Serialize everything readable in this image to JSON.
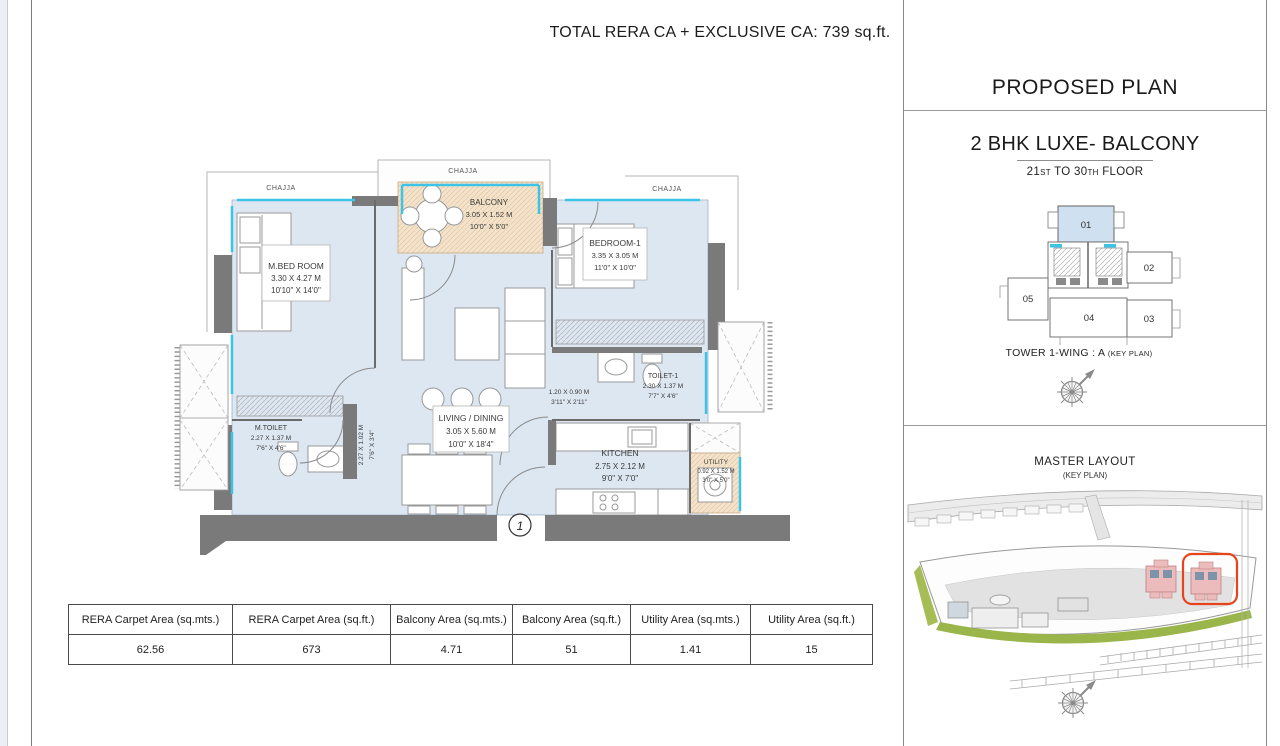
{
  "header": {
    "title": "TOTAL RERA CA + EXCLUSIVE CA: 739 sq.ft."
  },
  "right_panel": {
    "heading": "PROPOSED PLAN",
    "plan_title": "2 BHK LUXE- BALCONY",
    "floor_range": {
      "n1": "21",
      "s1": "ST",
      "mid": " TO 30",
      "s2": "TH",
      "tail": " FLOOR"
    },
    "key_plan": {
      "units": [
        "01",
        "02",
        "03",
        "04",
        "05"
      ],
      "caption": "TOWER 1-WING : A",
      "caption_suffix": "(KEY PLAN)",
      "highlight_color": "#cfe0f0"
    },
    "master_layout": {
      "title": "MASTER LAYOUT",
      "subtitle": "(KEY PLAN)",
      "highlight_color": "#e8441c"
    }
  },
  "floor_plan": {
    "chajja_label": "CHAJJA",
    "entry_marker": "1",
    "rooms": {
      "master_bedroom": {
        "name": "M.BED ROOM",
        "dim_m": "3.30 X 4.27 M",
        "dim_ft": "10'10\" X 14'0\""
      },
      "balcony": {
        "name": "BALCONY",
        "dim_m": "3.05 X 1.52 M",
        "dim_ft": "10'0\" X 5'0\""
      },
      "bedroom1": {
        "name": "BEDROOM-1",
        "dim_m": "3.35 X 3.05 M",
        "dim_ft": "11'0\" X 10'0\""
      },
      "living_dining": {
        "name": "LIVING / DINING",
        "dim_m": "3.05 X 5.60 M",
        "dim_ft": "10'0\" X 18'4\""
      },
      "kitchen": {
        "name": "KITCHEN",
        "dim_m": "2.75 X 2.12 M",
        "dim_ft": "9'0\" X 7'0\""
      },
      "toilet1": {
        "name": "TOILET-1",
        "dim_m": "2.30 X 1.37 M",
        "dim_ft": "7'7\" X 4'6\""
      },
      "master_toilet": {
        "name": "M.TOILET",
        "dim_m": "2.27 X 1.37 M",
        "dim_ft": "7'6\" X 4'6\""
      },
      "utility": {
        "name": "UTILITY",
        "dim_m": "0.92 X 1.52 M",
        "dim_ft": "3'0\" X 5'0\""
      },
      "passage": {
        "dim_m": "1.20 X 0.90 M",
        "dim_ft": "3'11\" X 2'11\""
      },
      "passage_vertical": {
        "dim_m": "2.27 X 1.02 M",
        "dim_ft": "7'6\" X 3'4\""
      }
    },
    "colors": {
      "floor": "#dde7f2",
      "wall": "#7a7a7a",
      "balcony_floor": "#f4e3cc",
      "window": "#3cc3e6"
    }
  },
  "area_table": {
    "headers": [
      "RERA Carpet Area (sq.mts.)",
      "RERA Carpet Area (sq.ft.)",
      "Balcony Area (sq.mts.)",
      "Balcony Area (sq.ft.)",
      "Utility Area (sq.mts.)",
      "Utility Area (sq.ft.)"
    ],
    "values": [
      "62.56",
      "673",
      "4.71",
      "51",
      "1.41",
      "15"
    ]
  }
}
